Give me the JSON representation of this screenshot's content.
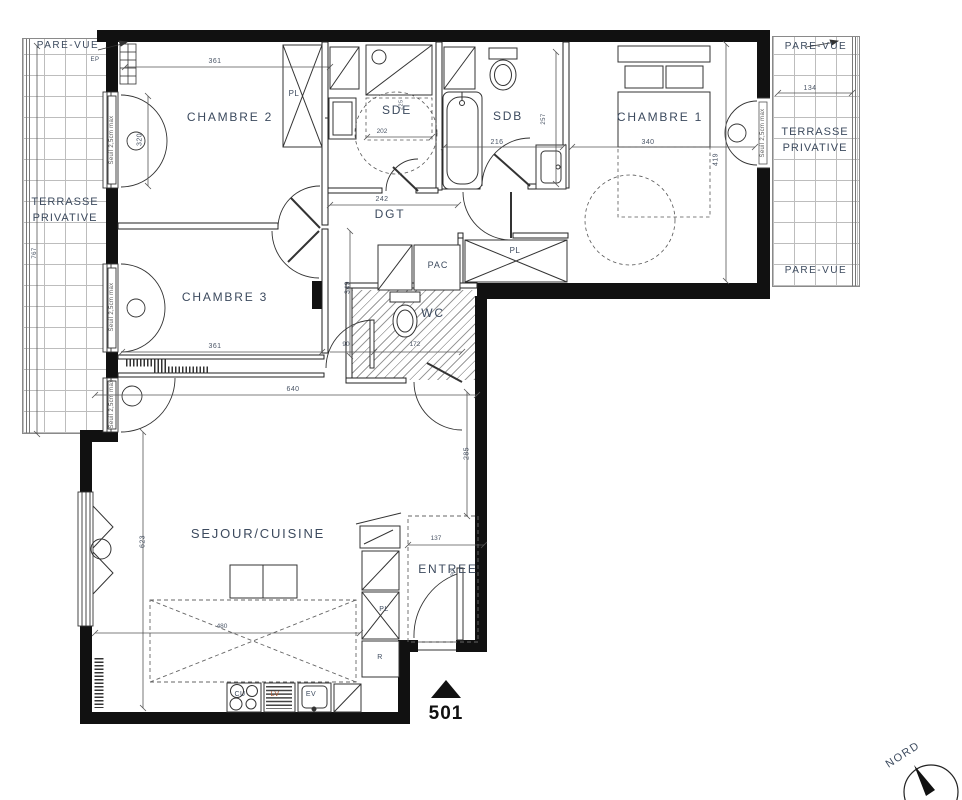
{
  "plan": {
    "unit_number": "501",
    "north_label": "NORD",
    "rooms": {
      "chambre1": "CHAMBRE 1",
      "chambre2": "CHAMBRE 2",
      "chambre3": "CHAMBRE 3",
      "sde": "SDE",
      "sdb": "SDB",
      "dgt": "DGT",
      "wc": "WC",
      "sejour_cuisine": "SEJOUR/CUISINE",
      "entree": "ENTREE",
      "terrasse_line1": "TERRASSE",
      "terrasse_line2": "PRIVATIVE",
      "pare_vue": "PARE-VUE"
    },
    "equip": {
      "pac": "PAC",
      "placard": "PL",
      "cooktop": "CU",
      "dishwasher": "LV",
      "sink": "EV",
      "fridge": "R",
      "downpipe": "EP"
    },
    "notes": {
      "seuil": "Seuil 2,5cm max"
    },
    "dims": {
      "chambre2_width": "361",
      "chambre2_window": "320",
      "sde_depth": "225",
      "sde_width": "202",
      "sdb_width": "216",
      "sdb_depth": "257",
      "chambre1_width": "340",
      "chambre1_depth": "419",
      "terrasse_right_width": "134",
      "terrasse_left_depth": "767",
      "chambre3_width": "361",
      "dgt_width": "242",
      "dgt_depth": "349",
      "wc_door": "90",
      "wc_width": "172",
      "sejour_width": "640",
      "sejour_depth": "623",
      "sejour_east": "285",
      "kitchen_width": "480",
      "entree_width": "137",
      "entree_door": "90"
    },
    "colors": {
      "wall": "#111111",
      "line": "#333333",
      "label": "#3c4a5e",
      "dim": "#4a5566"
    }
  }
}
